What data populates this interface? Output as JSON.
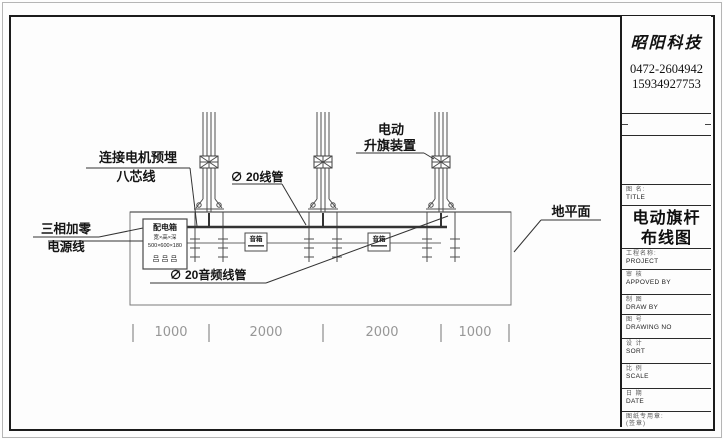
{
  "title_block": {
    "company_name": "昭阳科技",
    "phone_line1": "0472-2604942",
    "phone_line2": "15934927753",
    "title_field_label_cn": "图 名:",
    "title_field_label_en": "TITLE",
    "drawing_title_line1": "电动旗杆",
    "drawing_title_line2": "布线图",
    "project_field_label_cn": "工程名称:",
    "project_field_label_en": "PROJECT",
    "fields": [
      {
        "cn": "审 核",
        "en": "APPOVED BY"
      },
      {
        "cn": "制 图",
        "en": "DRAW BY"
      },
      {
        "cn": "图 号",
        "en": "DRAWING NO"
      },
      {
        "cn": "设 计",
        "en": "SORT"
      },
      {
        "cn": "比 例",
        "en": "SCALE"
      },
      {
        "cn": "日 期",
        "en": "DATE"
      }
    ],
    "stamp_field_label": "图纸专用章:",
    "stamp_field_note": "(签章)"
  },
  "drawing": {
    "labels": {
      "power_line_1": "三相加零",
      "power_line_2": "电源线",
      "motor_wire_1": "连接电机预埋",
      "motor_wire_2": "八芯线",
      "conduit": "∅ 20线管",
      "audio_conduit": "∅ 20音频线管",
      "hoist_line_1": "电动",
      "hoist_line_2": "升旗装置",
      "ground_plane": "地平面"
    },
    "distribution_box": {
      "title": "配电箱",
      "size_label": "宽×高×深",
      "size_value": "500×600×180",
      "breaker_symbols": "吕 吕 吕"
    },
    "speaker_label": "音箱",
    "dimensions": [
      "1000",
      "2000",
      "2000",
      "1000"
    ]
  }
}
